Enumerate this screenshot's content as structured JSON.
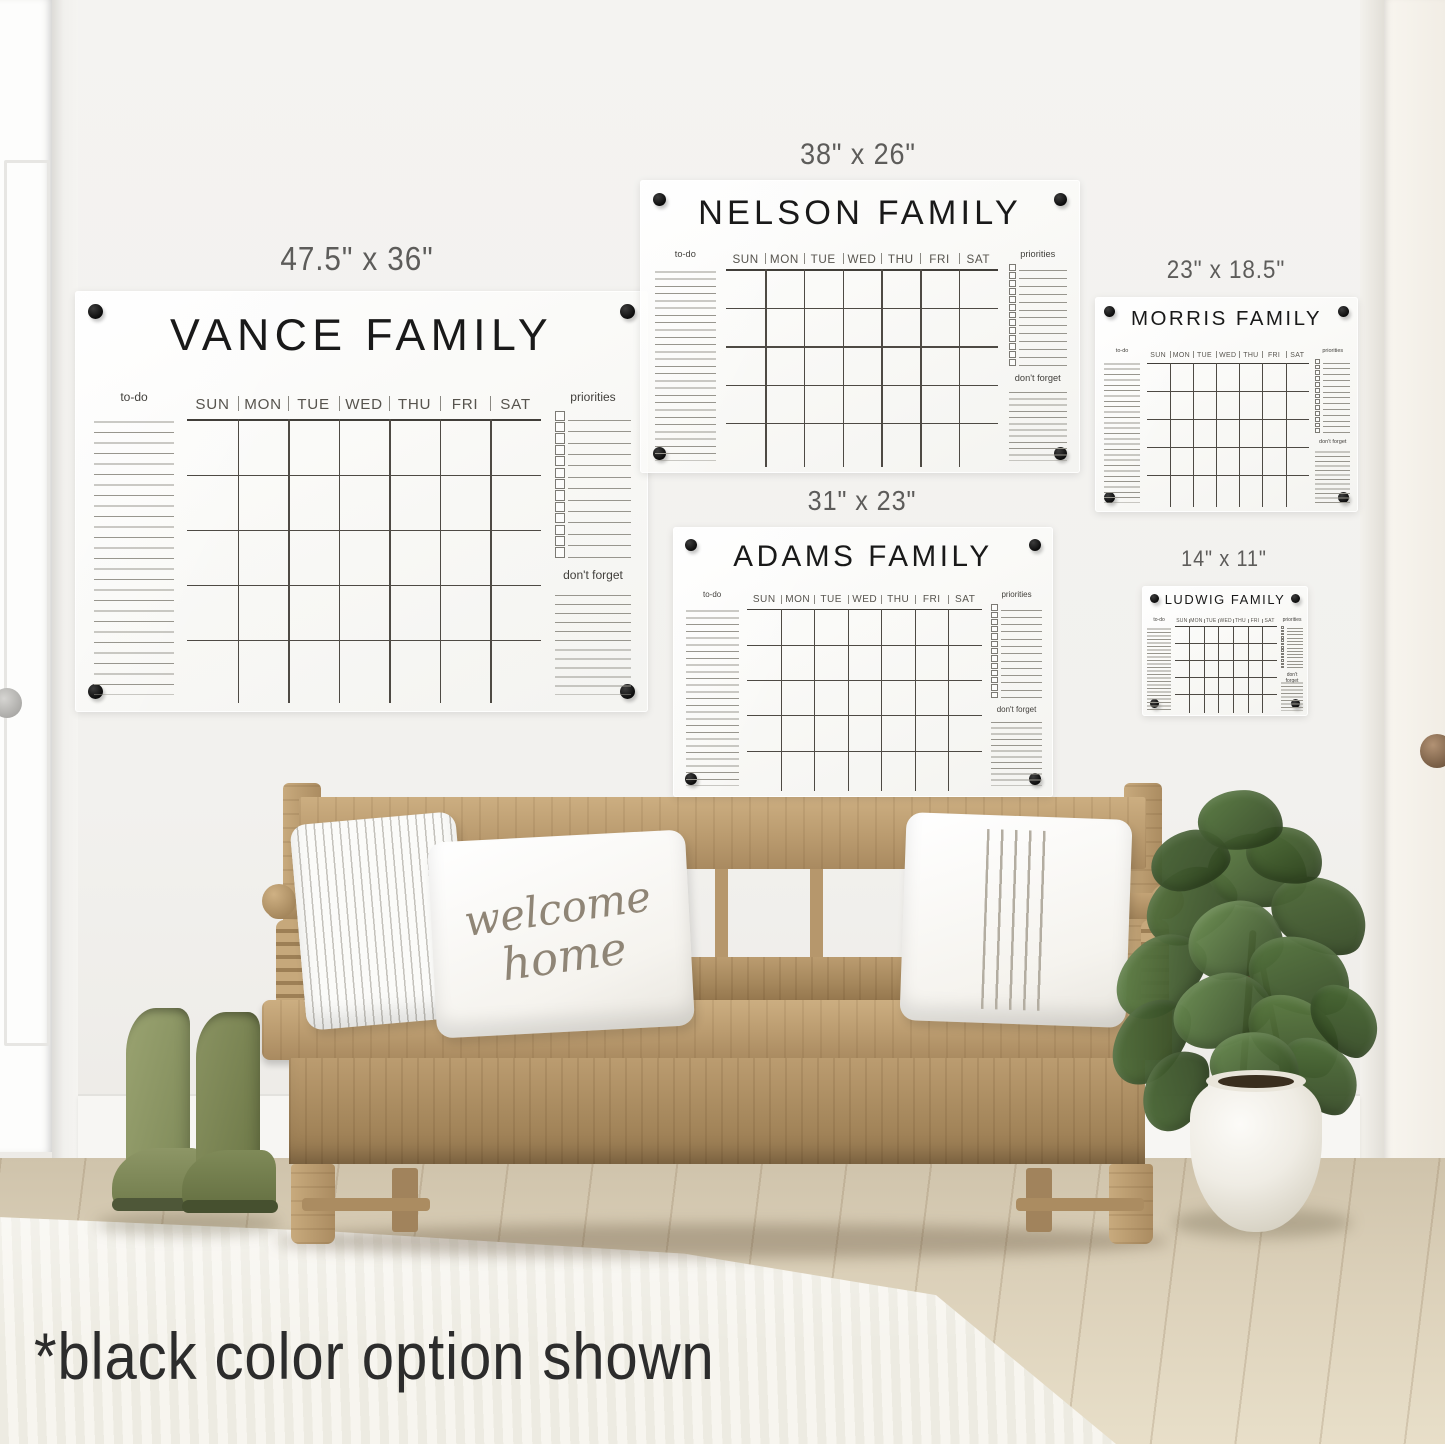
{
  "note": "*black color option shown",
  "pillow": {
    "line1": "welcome",
    "line2": "home"
  },
  "calendars": [
    {
      "id": "vance",
      "name": "VANCE FAMILY",
      "size_label": "47.5\" x 36\""
    },
    {
      "id": "nelson",
      "name": "NELSON FAMILY",
      "size_label": "38\" x 26\""
    },
    {
      "id": "morris",
      "name": "MORRIS FAMILY",
      "size_label": "23\" x 18.5\""
    },
    {
      "id": "adams",
      "name": "ADAMS FAMILY",
      "size_label": "31\" x 23\""
    },
    {
      "id": "ludwig",
      "name": "LUDWIG FAMILY",
      "size_label": "14\" x 11\""
    }
  ],
  "calendar_template": {
    "todo_label": "to-do",
    "days": [
      "SUN",
      "MON",
      "TUE",
      "WED",
      "THU",
      "FRI",
      "SAT"
    ],
    "priorities_label": "priorities",
    "dont_forget_label": "don't forget",
    "todo_line_count": 27,
    "priorities_checkbox_count": 13,
    "dont_forget_line_count": 12,
    "grid_rows": 5
  },
  "colors": {
    "standoff_hardware": "#141414",
    "calendar_text": "#191919",
    "boots_green": "#8e9768",
    "bench_wood": "#bf9f73",
    "plant_leaf": "#64854b"
  }
}
